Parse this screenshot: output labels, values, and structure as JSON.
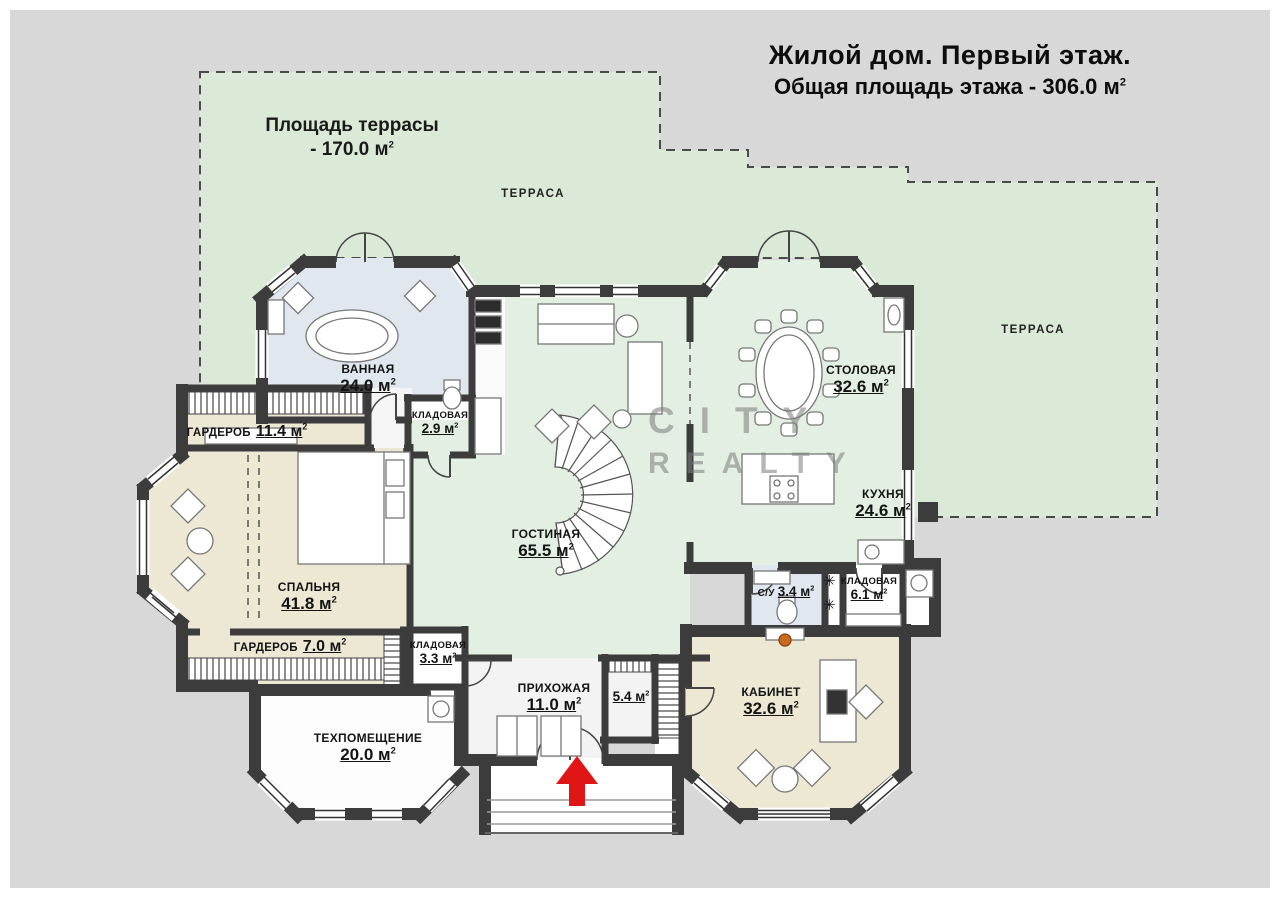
{
  "sup2": "2",
  "title": {
    "line1": "Жилой дом. Первый этаж.",
    "line2": "Общая площадь этажа - 306.0 м"
  },
  "terrace": {
    "area_line1": "Площадь террасы",
    "area_line2": "- 170.0 м",
    "label_top": "ТЕРРАСА",
    "label_right": "ТЕРРАСА"
  },
  "watermark": {
    "word1": "CITY",
    "word2": "REALTY"
  },
  "icons": {
    "vent": "✳"
  },
  "rooms": {
    "bathroom": {
      "name": "ВАННАЯ",
      "area": "24.0 м"
    },
    "wardrobe1": {
      "name": "ГАРДЕРОБ",
      "area": "11.4 м"
    },
    "storage1": {
      "name": "КЛАДОВАЯ",
      "area": "2.9 м"
    },
    "dining": {
      "name": "СТОЛОВАЯ",
      "area": "32.6 м"
    },
    "kitchen": {
      "name": "КУХНЯ",
      "area": "24.6 м"
    },
    "living": {
      "name": "ГОСТИНАЯ",
      "area": "65.5 м"
    },
    "bedroom": {
      "name": "СПАЛЬНЯ",
      "area": "41.8 м"
    },
    "wardrobe2": {
      "name": "ГАРДЕРОБ",
      "area": "7.0 м"
    },
    "storage2": {
      "name": "КЛАДОВАЯ",
      "area": "3.3 м"
    },
    "hallway": {
      "name": "ПРИХОЖАЯ",
      "area": "11.0 м"
    },
    "room54": {
      "area": "5.4 м"
    },
    "tech": {
      "name": "ТЕХПОМЕЩЕНИЕ",
      "area": "20.0 м"
    },
    "cabinet": {
      "name": "КАБИНЕТ",
      "area": "32.6 м"
    },
    "wc": {
      "name": "С/У",
      "area": "3.4 м"
    },
    "storage3": {
      "name": "КЛАДОВАЯ",
      "area": "6.1 м"
    }
  },
  "colors": {
    "canvas": "#d8d8d8",
    "terrace": "#dbe9d7",
    "wall": "#3c3c3c",
    "bathroom": "#e0e7ee",
    "bedroom": "#ece8d3",
    "living": "#e4efe3",
    "arrow": "#e01515",
    "watermark": "#8f8f8f"
  }
}
